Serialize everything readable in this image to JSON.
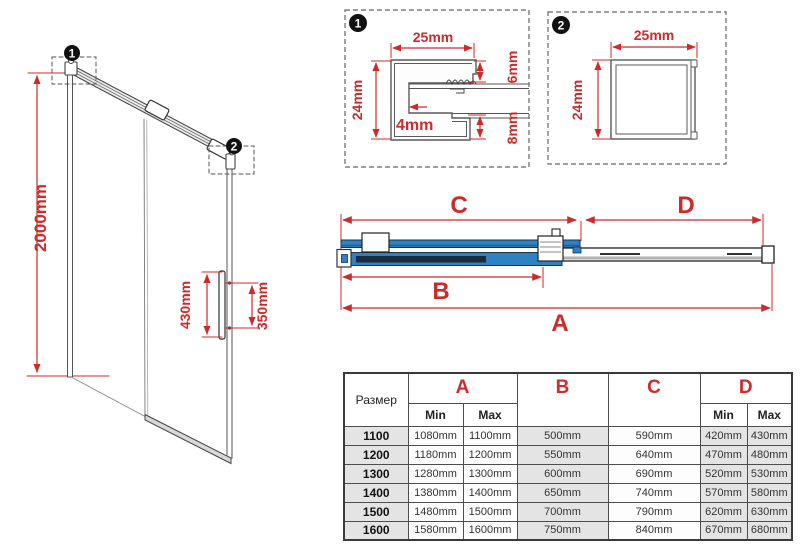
{
  "colors": {
    "dimension_red": "#cd2a2a",
    "glass_blue": "#2f81c2",
    "profile_navy": "#1c2a3a",
    "line_gray": "#4a4a4a",
    "table_cell_gray": "#e4e4e4"
  },
  "left_view": {
    "marker1": "1",
    "marker2": "2",
    "height_label": "2000mm",
    "handle_length_label": "430mm",
    "handle_holes_label": "350mm"
  },
  "detail1": {
    "badge": "1",
    "width_label": "25mm",
    "height_label": "24mm",
    "slot_label": "4mm",
    "top_arm_label": "6mm",
    "bottom_arm_label": "8mm"
  },
  "detail2": {
    "badge": "2",
    "width_label": "25mm",
    "height_label": "24mm"
  },
  "top_view": {
    "dim_a": "A",
    "dim_b": "B",
    "dim_c": "C",
    "dim_d": "D"
  },
  "table": {
    "size_header": "Размер",
    "col_a": "A",
    "col_b": "B",
    "col_c": "C",
    "col_d": "D",
    "min_label": "Min",
    "max_label": "Max",
    "rows": [
      {
        "size": "1100",
        "a_min": "1080mm",
        "a_max": "1100mm",
        "b": "500mm",
        "c": "590mm",
        "d_min": "420mm",
        "d_max": "430mm"
      },
      {
        "size": "1200",
        "a_min": "1180mm",
        "a_max": "1200mm",
        "b": "550mm",
        "c": "640mm",
        "d_min": "470mm",
        "d_max": "480mm"
      },
      {
        "size": "1300",
        "a_min": "1280mm",
        "a_max": "1300mm",
        "b": "600mm",
        "c": "690mm",
        "d_min": "520mm",
        "d_max": "530mm"
      },
      {
        "size": "1400",
        "a_min": "1380mm",
        "a_max": "1400mm",
        "b": "650mm",
        "c": "740mm",
        "d_min": "570mm",
        "d_max": "580mm"
      },
      {
        "size": "1500",
        "a_min": "1480mm",
        "a_max": "1500mm",
        "b": "700mm",
        "c": "790mm",
        "d_min": "620mm",
        "d_max": "630mm"
      },
      {
        "size": "1600",
        "a_min": "1580mm",
        "a_max": "1600mm",
        "b": "750mm",
        "c": "840mm",
        "d_min": "670mm",
        "d_max": "680mm"
      }
    ]
  }
}
